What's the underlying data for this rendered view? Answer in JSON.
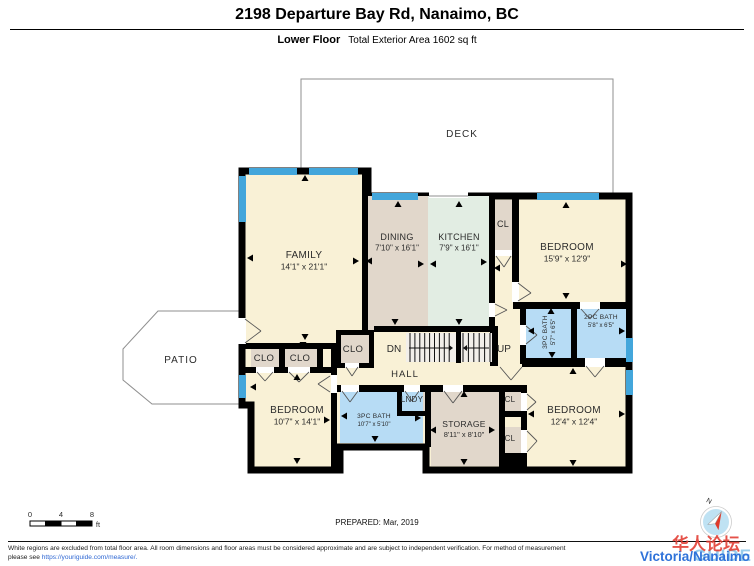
{
  "header": {
    "title": "2198 Departure Bay Rd, Nanaimo, BC",
    "floor_label": "Lower Floor",
    "area_label": "Total Exterior Area 1602 sq ft"
  },
  "footer": {
    "prepared": "PREPARED: Mar, 2019",
    "scale": {
      "ticks": [
        "0",
        "4",
        "8"
      ],
      "unit": "ft"
    },
    "compass_n": "N",
    "disclaimer_line1": "White regions are excluded from total floor area. All room dimensions and floor areas must be considered approximate and are subject to independent verification. For method of measurement",
    "disclaimer_line2_prefix": "please see ",
    "disclaimer_link": "https://youriguide.com/measure/."
  },
  "watermark": {
    "chinese": "华人论坛",
    "blue_text": "Victoria/Nanaimo",
    "guide_text": "GUIDE"
  },
  "colors": {
    "cream": "#F9F1D6",
    "taupe": "#E1D7CB",
    "mint": "#E2EDE3",
    "bath_blue": "#B7DCF5",
    "window_blue": "#43A6DB",
    "wall": "#000000",
    "outline_gray": "#8F8F8F",
    "stair_fill": "#F2EFEA",
    "label": "#2B2B2B",
    "compass_fill": "#BFE2F3",
    "needle_red": "#E03A2A"
  },
  "plan": {
    "deck": {
      "points": "301,79 613,79 613,196 368,196 368,171 301,171",
      "label": "DECK",
      "lx": 462,
      "ly": 137
    },
    "patio": {
      "points": "158,311 242,311 242,404 152,404 123,380 123,349",
      "label": "PATIO",
      "lx": 181,
      "ly": 363
    },
    "footprint": "242,171 368,171 368,196 629,196 629,470 426,470 426,447 340,447 340,470 251,470 251,405 242,405",
    "fills": [
      {
        "n": "dining-floor",
        "c": "taupe",
        "r": [
          368,
          196,
          60,
          136
        ]
      },
      {
        "n": "kitchen-floor",
        "c": "mint",
        "r": [
          428,
          196,
          61,
          136
        ]
      },
      {
        "n": "closet-top-floor",
        "c": "taupe",
        "r": [
          495,
          200,
          17,
          50
        ]
      },
      {
        "n": "bath3-right-floor",
        "c": "bath_blue",
        "r": [
          526,
          306,
          45,
          52
        ]
      },
      {
        "n": "bath2-floor",
        "c": "bath_blue",
        "r": [
          577,
          306,
          49,
          52
        ]
      },
      {
        "n": "storage-floor",
        "c": "taupe",
        "r": [
          431,
          392,
          68,
          74
        ]
      },
      {
        "n": "laundry-floor",
        "c": "taupe",
        "r": [
          402,
          390,
          23,
          21
        ]
      },
      {
        "n": "bath3-bottom-floor",
        "c": "bath_blue",
        "r": [
          340,
          392,
          83,
          51
        ]
      },
      {
        "n": "closet1-floor",
        "c": "taupe",
        "r": [
          251,
          349,
          28,
          18
        ]
      },
      {
        "n": "closet2-floor",
        "c": "taupe",
        "r": [
          285,
          349,
          32,
          18
        ]
      },
      {
        "n": "closet-mid-floor",
        "c": "taupe",
        "r": [
          341,
          335,
          28,
          28
        ]
      },
      {
        "n": "cl-upper-floor",
        "c": "taupe",
        "r": [
          505,
          390,
          16,
          21
        ]
      },
      {
        "n": "cl-lower-floor",
        "c": "taupe",
        "r": [
          505,
          427,
          16,
          26
        ]
      }
    ],
    "walls": [
      [
        362,
        171,
        6,
        159
      ],
      [
        242,
        343,
        98,
        6
      ],
      [
        245,
        367,
        14,
        6
      ],
      [
        274,
        367,
        16,
        6
      ],
      [
        310,
        367,
        27,
        6
      ],
      [
        279,
        349,
        6,
        18
      ],
      [
        317,
        349,
        6,
        18
      ],
      [
        331,
        343,
        6,
        32
      ],
      [
        331,
        393,
        6,
        80
      ],
      [
        336,
        330,
        38,
        5
      ],
      [
        336,
        330,
        5,
        38
      ],
      [
        369,
        330,
        5,
        38
      ],
      [
        336,
        363,
        9,
        5
      ],
      [
        359,
        363,
        15,
        5
      ],
      [
        374,
        326,
        123,
        6
      ],
      [
        490,
        326,
        8,
        40
      ],
      [
        489,
        196,
        6,
        107
      ],
      [
        489,
        317,
        6,
        11
      ],
      [
        512,
        196,
        7,
        86
      ],
      [
        513,
        302,
        67,
        7
      ],
      [
        600,
        302,
        29,
        7
      ],
      [
        571,
        302,
        6,
        62
      ],
      [
        520,
        302,
        6,
        23
      ],
      [
        520,
        345,
        6,
        19
      ],
      [
        522,
        358,
        63,
        9
      ],
      [
        605,
        358,
        24,
        9
      ],
      [
        337,
        385,
        4,
        7
      ],
      [
        359,
        385,
        45,
        7
      ],
      [
        420,
        385,
        23,
        7
      ],
      [
        463,
        385,
        59,
        7
      ],
      [
        397,
        390,
        5,
        23
      ],
      [
        397,
        411,
        28,
        5
      ],
      [
        425,
        385,
        6,
        62
      ],
      [
        499,
        385,
        6,
        88
      ],
      [
        499,
        411,
        28,
        6
      ],
      [
        499,
        453,
        28,
        17
      ],
      [
        521,
        385,
        6,
        8
      ],
      [
        521,
        411,
        6,
        19
      ],
      [
        521,
        453,
        6,
        17
      ]
    ],
    "stairs": {
      "x": 406,
      "y": 333,
      "w": 86,
      "h": 29,
      "divider": [
        456,
        331,
        5,
        32
      ],
      "flights": [
        {
          "x1": 410,
          "x2": 454,
          "step": 4.9
        },
        {
          "x1": 463,
          "x2": 490,
          "step": 5.4
        }
      ],
      "mid_y": 348,
      "arrows": [
        {
          "x1": 409,
          "x2": 449,
          "head": "r"
        },
        {
          "x1": 467,
          "x2": 489,
          "head": "l"
        }
      ],
      "dn_label": "DN",
      "dn_x": 394,
      "dn_y": 352,
      "up_label": "UP",
      "up_x": 504,
      "up_y": 352
    },
    "windows": [
      [
        249,
        168,
        48,
        7
      ],
      [
        309,
        168,
        49,
        7
      ],
      [
        372,
        193,
        46,
        7
      ],
      [
        537,
        193,
        62,
        7
      ],
      [
        239,
        176,
        7,
        46
      ],
      [
        239,
        375,
        7,
        23
      ],
      [
        626,
        338,
        7,
        24
      ],
      [
        626,
        370,
        7,
        25
      ]
    ],
    "door_gaps": [
      [
        238,
        318,
        8,
        26
      ],
      [
        429,
        190,
        39,
        8
      ],
      [
        489,
        303,
        6,
        14
      ],
      [
        512,
        282,
        7,
        20
      ],
      [
        495,
        250,
        17,
        6
      ],
      [
        520,
        325,
        6,
        20
      ],
      [
        580,
        302,
        20,
        7
      ],
      [
        585,
        358,
        20,
        9
      ],
      [
        521,
        393,
        6,
        18
      ],
      [
        521,
        430,
        6,
        23
      ],
      [
        443,
        385,
        20,
        7
      ],
      [
        404,
        385,
        16,
        7
      ],
      [
        341,
        385,
        18,
        7
      ],
      [
        331,
        375,
        6,
        18
      ],
      [
        256,
        367,
        18,
        6
      ],
      [
        288,
        367,
        22,
        6
      ],
      [
        345,
        363,
        14,
        5
      ]
    ],
    "door_lines": [
      [
        245,
        319,
        261,
        331
      ],
      [
        245,
        343,
        261,
        331
      ],
      [
        495,
        304,
        507,
        310
      ],
      [
        495,
        316,
        507,
        310
      ],
      [
        518,
        283,
        531,
        293
      ],
      [
        518,
        301,
        531,
        293
      ],
      [
        496,
        256,
        504,
        267
      ],
      [
        511,
        256,
        504,
        267
      ],
      [
        526,
        326,
        537,
        335
      ],
      [
        526,
        344,
        537,
        335
      ],
      [
        581,
        309,
        590,
        319
      ],
      [
        599,
        309,
        590,
        319
      ],
      [
        586,
        366,
        595,
        377
      ],
      [
        604,
        366,
        595,
        377
      ],
      [
        500,
        367,
        511,
        380
      ],
      [
        522,
        367,
        511,
        380
      ],
      [
        527,
        394,
        536,
        402
      ],
      [
        527,
        410,
        536,
        402
      ],
      [
        527,
        431,
        537,
        441
      ],
      [
        527,
        452,
        537,
        441
      ],
      [
        444,
        391,
        453,
        403
      ],
      [
        462,
        391,
        453,
        403
      ],
      [
        405,
        391,
        412,
        401
      ],
      [
        419,
        391,
        412,
        401
      ],
      [
        342,
        391,
        350,
        402
      ],
      [
        358,
        391,
        350,
        402
      ],
      [
        330,
        376,
        318,
        384
      ],
      [
        330,
        392,
        318,
        384
      ],
      [
        257,
        372,
        265,
        381
      ],
      [
        273,
        372,
        265,
        381
      ],
      [
        289,
        372,
        299,
        382
      ],
      [
        309,
        372,
        299,
        382
      ],
      [
        346,
        367,
        352,
        376
      ],
      [
        358,
        367,
        352,
        376
      ]
    ],
    "openings": [
      [
        429,
        196,
        468,
        196
      ]
    ],
    "labels": [
      {
        "n": "room-label-family",
        "t": "FAMILY",
        "s": "14'1\" x 21'1\"",
        "x": 304,
        "y": 258,
        "f": 10,
        "fs": 8.5
      },
      {
        "n": "room-label-dining",
        "t": "DINING",
        "s": "7'10\" x 16'1\"",
        "x": 397,
        "y": 240,
        "f": 9,
        "fs": 8
      },
      {
        "n": "room-label-kitchen",
        "t": "KITCHEN",
        "s": "7'9\" x 16'1\"",
        "x": 459,
        "y": 240,
        "f": 9,
        "fs": 8
      },
      {
        "n": "room-label-cl-top",
        "t": "CL",
        "x": 503,
        "y": 227,
        "f": 9
      },
      {
        "n": "room-label-bedroom-tr",
        "t": "BEDROOM",
        "s": "15'9\" x 12'9\"",
        "x": 567,
        "y": 250,
        "f": 10,
        "fs": 8.5
      },
      {
        "n": "room-label-bath3-right",
        "t": "3PC BATH",
        "s": "5'7\" x 6'5\"",
        "x": 549,
        "y": 332,
        "f": 6.5,
        "fs": 6,
        "rot": -90
      },
      {
        "n": "room-label-bath2",
        "t": "2PC BATH",
        "s": "5'8\" x 6'5\"",
        "x": 601,
        "y": 319,
        "f": 6.5,
        "fs": 6
      },
      {
        "n": "room-label-bedroom-br",
        "t": "BEDROOM",
        "s": "12'4\" x 12'4\"",
        "x": 574,
        "y": 413,
        "f": 10,
        "fs": 8.5
      },
      {
        "n": "room-label-bedroom-bl",
        "t": "BEDROOM",
        "s": "10'7\" x 14'1\"",
        "x": 297,
        "y": 413,
        "f": 10,
        "fs": 8.5
      },
      {
        "n": "room-label-bath3-bottom",
        "t": "3PC BATH",
        "s": "10'7\" x 5'10\"",
        "x": 374,
        "y": 418,
        "f": 6.5,
        "fs": 6
      },
      {
        "n": "room-label-storage",
        "t": "STORAGE",
        "s": "8'11\" x 8'10\"",
        "x": 464,
        "y": 427,
        "f": 8.5,
        "fs": 7.5
      },
      {
        "n": "room-label-laundry",
        "t": "LNDY",
        "x": 412,
        "y": 402,
        "f": 8
      },
      {
        "n": "room-label-clo1",
        "t": "CLO",
        "x": 264,
        "y": 361,
        "f": 9.5
      },
      {
        "n": "room-label-clo2",
        "t": "CLO",
        "x": 300,
        "y": 361,
        "f": 9.5
      },
      {
        "n": "room-label-clo-mid",
        "t": "CLO",
        "x": 353,
        "y": 352,
        "f": 9.5
      },
      {
        "n": "room-label-cl-upper",
        "t": "CL",
        "x": 510,
        "y": 402,
        "f": 8
      },
      {
        "n": "room-label-cl-lower",
        "t": "CL",
        "x": 510,
        "y": 441,
        "f": 8
      },
      {
        "n": "hall-label",
        "t": "HALL",
        "x": 405,
        "y": 377,
        "f": 9.5,
        "ls": 1
      }
    ],
    "arrows": [
      [
        305,
        178,
        "u"
      ],
      [
        398,
        204,
        "u"
      ],
      [
        459,
        204,
        "u"
      ],
      [
        566,
        205,
        "u"
      ],
      [
        250,
        258,
        "l"
      ],
      [
        356,
        261,
        "r"
      ],
      [
        369,
        261,
        "l"
      ],
      [
        421,
        264,
        "r"
      ],
      [
        433,
        264,
        "l"
      ],
      [
        484,
        262,
        "r"
      ],
      [
        497,
        268,
        "l"
      ],
      [
        305,
        337,
        "d"
      ],
      [
        395,
        322,
        "d"
      ],
      [
        459,
        322,
        "d"
      ],
      [
        624,
        264,
        "r"
      ],
      [
        566,
        296,
        "d"
      ],
      [
        551,
        311,
        "u"
      ],
      [
        552,
        355,
        "d"
      ],
      [
        531,
        331,
        "l"
      ],
      [
        622,
        331,
        "r"
      ],
      [
        573,
        371,
        "u"
      ],
      [
        531,
        414,
        "l"
      ],
      [
        622,
        414,
        "r"
      ],
      [
        573,
        463,
        "d"
      ],
      [
        464,
        394,
        "u"
      ],
      [
        433,
        430,
        "l"
      ],
      [
        492,
        430,
        "r"
      ],
      [
        464,
        462,
        "d"
      ],
      [
        344,
        416,
        "l"
      ],
      [
        418,
        418,
        "r"
      ],
      [
        375,
        439,
        "d"
      ],
      [
        253,
        387,
        "l"
      ],
      [
        297,
        377,
        "u"
      ],
      [
        297,
        461,
        "d"
      ],
      [
        327,
        420,
        "r"
      ],
      [
        303,
        345,
        "d"
      ]
    ],
    "scale_bar": {
      "x": 30,
      "y": 521,
      "seg": 15.5,
      "h": 5,
      "tick_y": 517,
      "unit_x": 98,
      "unit_y": 527
    },
    "compass": {
      "cx": 716,
      "cy": 522,
      "r": 14,
      "rot": 28,
      "nx": 708,
      "ny": 503
    }
  }
}
